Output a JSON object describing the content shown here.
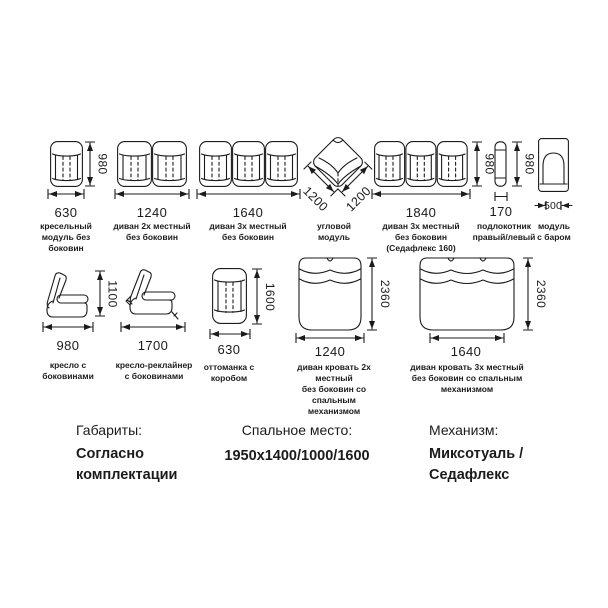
{
  "theme": {
    "ink_color": "#1b1b1b",
    "background": "#ffffff"
  },
  "row1": [
    {
      "name": "кресельный\nмодуль без\nбоковин",
      "width": "630",
      "height": "980"
    },
    {
      "name": "диван 2х местный\nбез боковин",
      "width": "1240"
    },
    {
      "name": "диван 3х местный\nбез боковин",
      "width": "1640"
    },
    {
      "name": "угловой\nмодуль",
      "depth_left": "1200",
      "depth_right": "1200"
    },
    {
      "name": "диван 3х местный\nбез боковин\n(Седафлекс 160)",
      "width": "1840",
      "height": "980"
    },
    {
      "name": "подлокотник\nправый/левый",
      "width": "170",
      "height": "980"
    },
    {
      "name": "модуль\nс баром",
      "width": "500"
    }
  ],
  "row2": [
    {
      "name": "кресло с\nбоковинами",
      "width": "980",
      "height": "1100"
    },
    {
      "name": "кресло-реклайнер\nс боковинами",
      "width": "1700"
    },
    {
      "name": "оттоманка с\nкоробом",
      "width": "630",
      "height": "1600"
    },
    {
      "name": "диван кровать 2х местный\nбез боковин со спальным\nмеханизмом",
      "width": "1240",
      "height": "2360"
    },
    {
      "name": "диван кровать 3х местный\nбез боковин со спальным\nмеханизмом",
      "width": "1640",
      "height": "2360"
    }
  ],
  "footer": {
    "dimensions_label": "Габариты:",
    "dimensions_value": "Согласно\nкомплектации",
    "sleeping_label": "Спальное место:",
    "sleeping_value": "1950х1400/1000/1600",
    "mechanism_label": "Механизм:",
    "mechanism_value": "Миксотуаль /\nСедафлекс"
  }
}
